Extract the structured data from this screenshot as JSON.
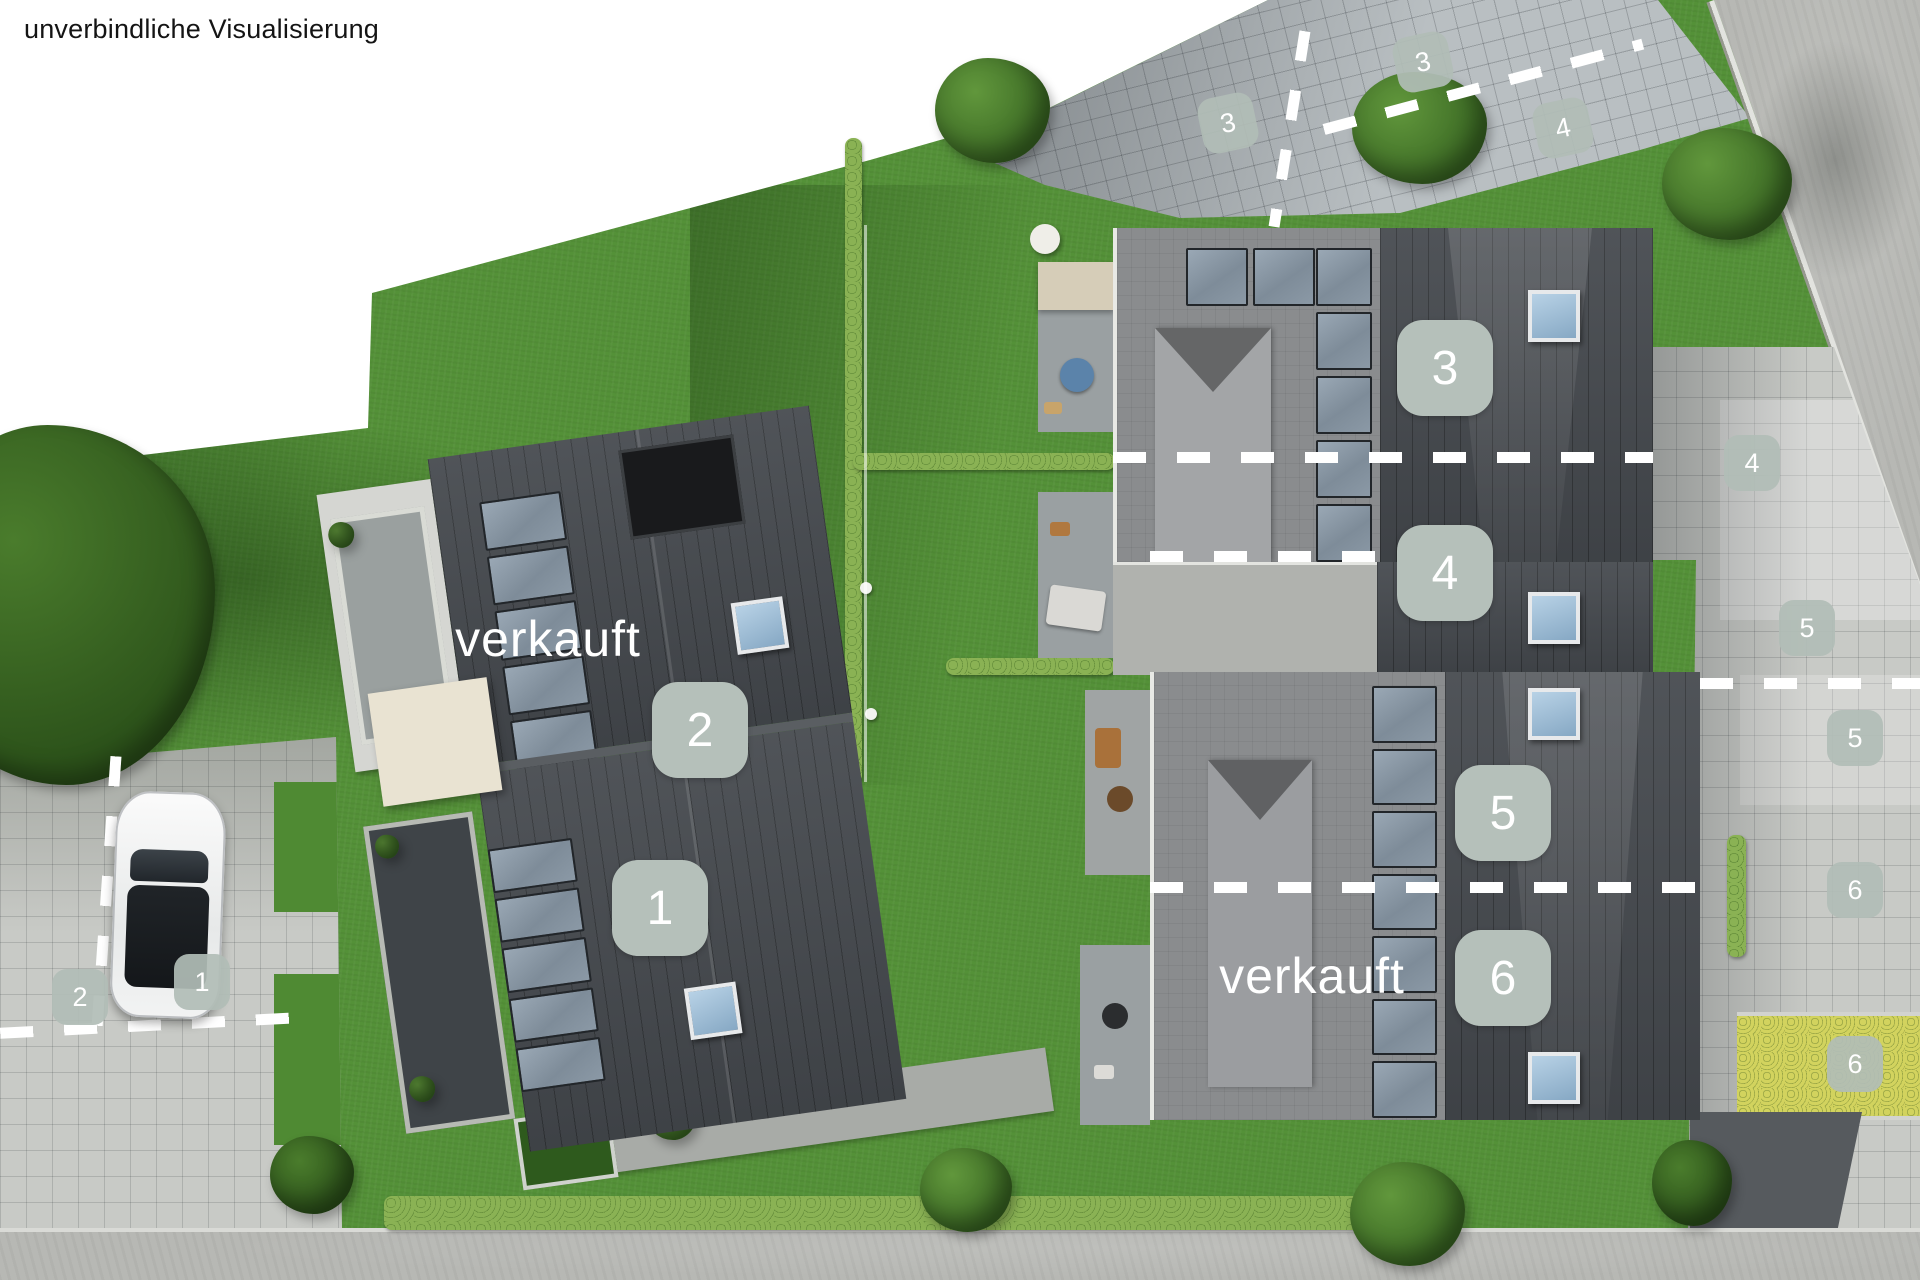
{
  "page": {
    "title": "unverbindliche Visualisierung"
  },
  "overlays": {
    "sold_left": "verkauft",
    "sold_right": "verkauft"
  },
  "unit_markers": [
    {
      "unit": "1",
      "number": "1"
    },
    {
      "unit": "2",
      "number": "2"
    },
    {
      "unit": "3",
      "number": "3"
    },
    {
      "unit": "4",
      "number": "4"
    },
    {
      "unit": "5",
      "number": "5"
    },
    {
      "unit": "6",
      "number": "6"
    }
  ],
  "parking_markers": [
    {
      "area": "left-parking",
      "number": "1"
    },
    {
      "area": "left-parking",
      "number": "2"
    },
    {
      "area": "top-driveway",
      "number": "3"
    },
    {
      "area": "top-driveway",
      "number": "3"
    },
    {
      "area": "top-driveway",
      "number": "4"
    },
    {
      "area": "right-parking",
      "number": "4"
    },
    {
      "area": "right-parking",
      "number": "5"
    },
    {
      "area": "right-parking",
      "number": "5"
    },
    {
      "area": "right-parking",
      "number": "6"
    },
    {
      "area": "right-parking",
      "number": "6"
    }
  ],
  "colors": {
    "unit_badge": "#b5c0ba",
    "sold_text": "#ffffff",
    "title_text": "#141414",
    "boundary_dash": "#ffffff",
    "grass": "#549138",
    "roof_dark": "#45494e",
    "roof_flat": "#8a8c8e",
    "pavement": "#c8cac6",
    "road": "#b7b8b4",
    "solar_panel": "#8795a3"
  }
}
